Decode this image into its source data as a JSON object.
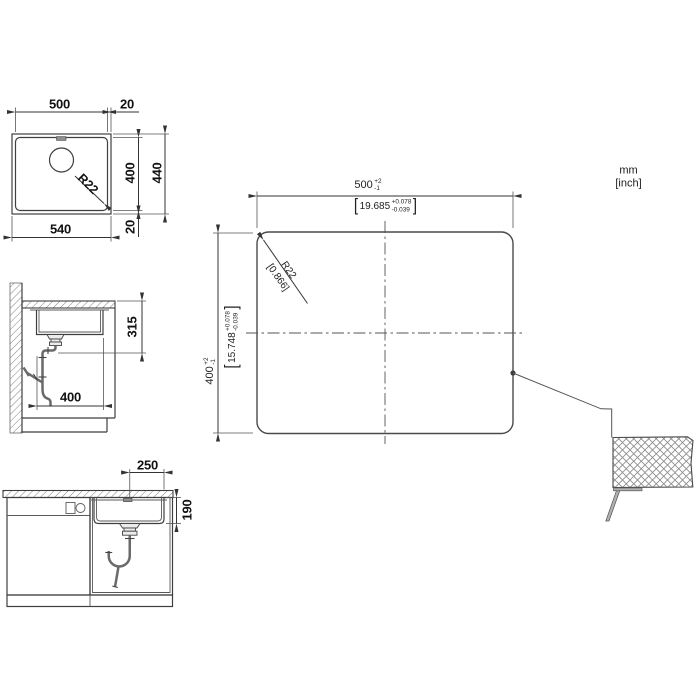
{
  "units": {
    "mm": "mm",
    "inch": "[inch]"
  },
  "symbols": {
    "lbracket": "[",
    "rbracket": "]"
  },
  "plan": {
    "width_inner": "500",
    "offset_right": "20",
    "depth_inner": "400",
    "depth_outer": "440",
    "width_outer": "540",
    "offset_bottom": "20",
    "radius": "R22"
  },
  "side": {
    "clearance_depth": "315",
    "bowl_depth": "400"
  },
  "front": {
    "half_width": "250",
    "bowl_height": "190"
  },
  "cutout": {
    "width": {
      "mm": "500",
      "plus": "+2",
      "minus": "-1",
      "inch": "19.685",
      "inch_plus": "+0.078",
      "inch_minus": "-0.039"
    },
    "height": {
      "mm": "400",
      "plus": "+2",
      "minus": "-1",
      "inch": "15.748",
      "inch_plus": "+0.078",
      "inch_minus": "-0.039"
    },
    "radius": {
      "mm": "R22",
      "inch": "[0.866]"
    }
  },
  "colors": {
    "line": "#3f3f3f",
    "thin": "#555555",
    "pipe": "#6a6a6a",
    "fill": "#b0b0b0"
  }
}
